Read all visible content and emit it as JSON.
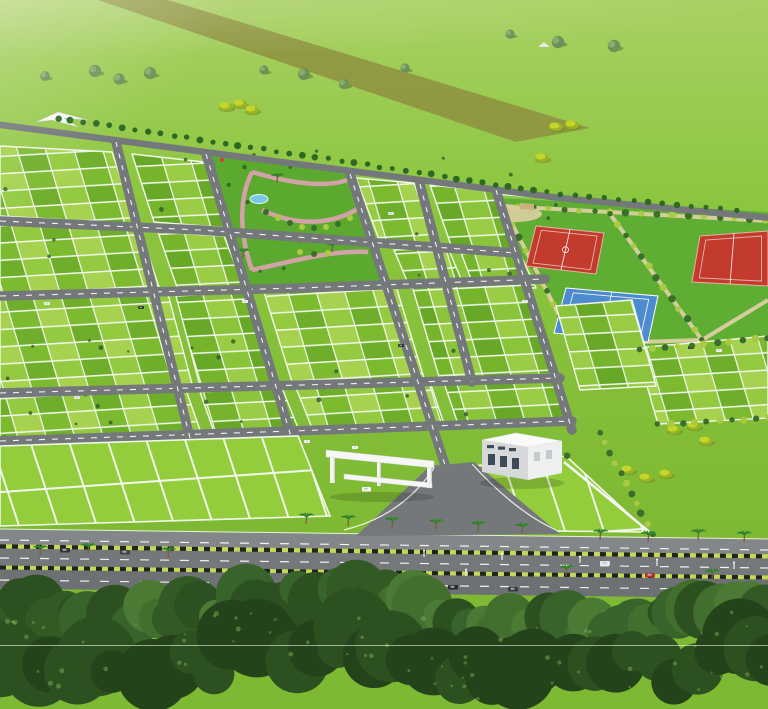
{
  "canvas": {
    "width": 768,
    "height": 709
  },
  "palette": {
    "field_top": "#a9d063",
    "field_mid": "#8cc63f",
    "field_low": "#7eb934",
    "haze": "#ffffff",
    "dirt_track": "#8e9140",
    "road": "#75787a",
    "road_light": "#84878a",
    "road_dark": "#6e7173",
    "road_dash": "#ffffff",
    "plot_greens_a": [
      "#a6d24f",
      "#7cba30",
      "#93ca40",
      "#6fae2b"
    ],
    "plot_greens_b": [
      "#9bcc45",
      "#76b42c",
      "#8ac43a",
      "#68a827"
    ],
    "front_green": "#93cd3b",
    "plot_line": "#f2f7ec",
    "park_lawn": "#5ca930",
    "park_path_pink": "#d2a2a8",
    "pond_blue": "#76c7e3",
    "sports_lawn": "#5fae33",
    "sand_path": "#dbcfa2",
    "court_red": "#c23b2c",
    "court_red_line": "#e9b0a6",
    "court_blue": "#4c8bcd",
    "court_blue_line": "#ffffff",
    "hedge_dark": "#3c6e2b",
    "hedge_light": "#a9cb42",
    "bush_yellow": "#c6d629",
    "bush_yellow_dark": "#99b424",
    "tree_gray_green": "#6f9157",
    "tree_gray_light": "#8aab6e",
    "boundary_tree": "#2c6a24",
    "white_structure": "#f6f6f4",
    "structure_shade": "#cfd1d3",
    "building_front": "#d6d8d9",
    "building_side": "#eef0f0",
    "building_roof": "#fafaf9",
    "window_dark": "#3e4b57",
    "curb_green": "#c6d856",
    "curb_black": "#20251a",
    "palm_leaf": "#2e7c28",
    "palm_leaf2": "#3f9233",
    "palm_trunk": "#7d5f3c",
    "canopy": [
      "#2d5020",
      "#38632a",
      "#426f2e",
      "#4a7a33",
      "#335a25"
    ],
    "canopy_dark": [
      "#24431b",
      "#2d5020"
    ],
    "canopy_speck": "#7fa855",
    "scan_line": "#eef3e8"
  },
  "field": {
    "dirt_track_pts": [
      [
        98,
        0
      ],
      [
        168,
        0
      ],
      [
        590,
        128
      ],
      [
        516,
        142
      ]
    ],
    "trees": [
      [
        45,
        76
      ],
      [
        95,
        71
      ],
      [
        119,
        79
      ],
      [
        150,
        73
      ],
      [
        264,
        70
      ],
      [
        304,
        74
      ],
      [
        344,
        84
      ],
      [
        405,
        68
      ],
      [
        510,
        34
      ],
      [
        558,
        42
      ],
      [
        614,
        46
      ]
    ],
    "hut": [
      544,
      44
    ],
    "yellow_bushes": [
      [
        226,
        107
      ],
      [
        240,
        104
      ],
      [
        252,
        110
      ],
      [
        542,
        158
      ],
      [
        556,
        127
      ],
      [
        572,
        125
      ],
      [
        628,
        470
      ],
      [
        646,
        478
      ],
      [
        666,
        474
      ],
      [
        674,
        430
      ],
      [
        694,
        426
      ],
      [
        706,
        441
      ]
    ]
  },
  "layout": {
    "boundary_road": "M -6 124 L 250 158 L 560 198 L 772 218",
    "boundary_trees": {
      "from": [
        58,
        118
      ],
      "to": [
        560,
        194
      ],
      "step": 13
    },
    "boundary_trees2": {
      "from": [
        560,
        194
      ],
      "to": [
        736,
        210
      ],
      "step": 14
    },
    "roads_a": [
      "M 0 221 L 200 230 L 420 246 L 516 253",
      "M 0 296 L 300 288 L 545 279",
      "M 0 393 L 340 384 L 560 378",
      "M 0 441 L 350 429 L 572 421"
    ],
    "roads_b": [
      "M 116 142 L 190 438",
      "M 206 154 L 292 440",
      "M 350 174 L 446 468 L 470 532",
      "M 420 184 L 472 382",
      "M 496 190 L 572 430"
    ],
    "blocks": [
      [
        [
          0,
          146
        ],
        [
          112,
          152
        ],
        [
          136,
          224
        ],
        [
          0,
          216
        ]
      ],
      [
        [
          132,
          154
        ],
        [
          204,
          162
        ],
        [
          230,
          228
        ],
        [
          154,
          222
        ]
      ],
      [
        [
          356,
          178
        ],
        [
          414,
          183
        ],
        [
          438,
          248
        ],
        [
          380,
          242
        ]
      ],
      [
        [
          430,
          185
        ],
        [
          492,
          191
        ],
        [
          516,
          252
        ],
        [
          452,
          248
        ]
      ],
      [
        [
          0,
          224
        ],
        [
          140,
          230
        ],
        [
          162,
          296
        ],
        [
          0,
          292
        ]
      ],
      [
        [
          158,
          232
        ],
        [
          224,
          236
        ],
        [
          248,
          298
        ],
        [
          180,
          296
        ]
      ],
      [
        [
          394,
          250
        ],
        [
          448,
          248
        ],
        [
          464,
          286
        ],
        [
          410,
          288
        ]
      ],
      [
        [
          460,
          250
        ],
        [
          520,
          254
        ],
        [
          536,
          288
        ],
        [
          474,
          287
        ]
      ],
      [
        [
          0,
          300
        ],
        [
          168,
          294
        ],
        [
          192,
          384
        ],
        [
          0,
          390
        ]
      ],
      [
        [
          176,
          296
        ],
        [
          248,
          292
        ],
        [
          274,
          382
        ],
        [
          200,
          386
        ]
      ],
      [
        [
          264,
          292
        ],
        [
          396,
          286
        ],
        [
          424,
          378
        ],
        [
          292,
          382
        ]
      ],
      [
        [
          412,
          286
        ],
        [
          524,
          280
        ],
        [
          550,
          374
        ],
        [
          440,
          380
        ]
      ],
      [
        [
          0,
          396
        ],
        [
          186,
          390
        ],
        [
          200,
          430
        ],
        [
          0,
          438
        ]
      ],
      [
        [
          200,
          392
        ],
        [
          282,
          388
        ],
        [
          298,
          428
        ],
        [
          214,
          432
        ]
      ],
      [
        [
          296,
          388
        ],
        [
          430,
          382
        ],
        [
          444,
          424
        ],
        [
          312,
          428
        ]
      ],
      [
        [
          444,
          383
        ],
        [
          556,
          378
        ],
        [
          568,
          420
        ],
        [
          458,
          424
        ]
      ],
      [
        [
          636,
          348
        ],
        [
          768,
          336
        ],
        [
          768,
          418
        ],
        [
          658,
          424
        ]
      ],
      [
        [
          556,
          306
        ],
        [
          632,
          300
        ],
        [
          656,
          386
        ],
        [
          580,
          390
        ]
      ]
    ],
    "front_blocks": [
      [
        [
          0,
          446
        ],
        [
          298,
          436
        ],
        [
          330,
          516
        ],
        [
          0,
          526
        ]
      ],
      [
        [
          436,
          470
        ],
        [
          566,
          456
        ],
        [
          648,
          532
        ],
        [
          448,
          530
        ]
      ]
    ],
    "hedge_rows": [
      {
        "from": [
          600,
          432
        ],
        "to": [
          652,
          534
        ],
        "step": 11
      },
      {
        "from": [
          658,
          424
        ],
        "to": [
          768,
          418
        ],
        "step": 12
      },
      {
        "from": [
          640,
          350
        ],
        "to": [
          768,
          338
        ],
        "step": 12
      },
      {
        "from": [
          436,
          470
        ],
        "to": [
          566,
          456
        ],
        "step": 13
      }
    ],
    "boundary_wall": "M 564 462 L 652 534",
    "vehicles": [
      [
        44,
        302,
        "#f2f2f2"
      ],
      [
        138,
        306,
        "#333333"
      ],
      [
        242,
        300,
        "#f2f2f2"
      ],
      [
        74,
        396,
        "#e8e8e8"
      ],
      [
        252,
        442,
        "#bb3a2e"
      ],
      [
        304,
        440,
        "#f5f5f5"
      ],
      [
        352,
        446,
        "#ffffff"
      ],
      [
        398,
        344,
        "#333333"
      ],
      [
        388,
        212,
        "#e5e5e5"
      ],
      [
        522,
        300,
        "#f0f0f0"
      ],
      [
        688,
        346,
        "#333333"
      ],
      [
        716,
        349,
        "#f5f5f5"
      ]
    ]
  },
  "park": {
    "lawn_pts": [
      [
        208,
        156
      ],
      [
        352,
        172
      ],
      [
        390,
        284
      ],
      [
        246,
        292
      ]
    ],
    "paths": [
      "M 252 270 C 240 236 238 200 252 172",
      "M 252 172 C 300 186 336 188 356 176",
      "M 252 270 C 290 262 330 250 368 252",
      "M 262 210 C 300 228 336 224 362 206"
    ],
    "pond": {
      "cx": 259,
      "cy": 199,
      "rx": 9,
      "ry": 4.5
    },
    "playground": [
      [
        196,
        163,
        "#cc4434"
      ],
      [
        205,
        159,
        "#d7a13a"
      ],
      [
        213,
        164,
        "#4a7fbf"
      ],
      [
        222,
        160,
        "#cc4434"
      ]
    ],
    "palms": [
      [
        277,
        183
      ],
      [
        300,
        243
      ],
      [
        332,
        252
      ],
      [
        243,
        258
      ]
    ],
    "hedges": [
      [
        266,
        212
      ],
      [
        278,
        218
      ],
      [
        290,
        223
      ],
      [
        302,
        227
      ],
      [
        314,
        228
      ],
      [
        326,
        227
      ],
      [
        338,
        224
      ],
      [
        350,
        218
      ],
      [
        360,
        210
      ],
      [
        300,
        252
      ],
      [
        314,
        254
      ],
      [
        328,
        253
      ]
    ],
    "canopy_pts": [
      [
        36,
        122
      ],
      [
        58,
        112
      ],
      [
        88,
        120
      ],
      [
        64,
        118
      ],
      [
        78,
        127
      ],
      [
        52,
        120
      ]
    ]
  },
  "sports": {
    "lawn_pts": [
      [
        498,
        198
      ],
      [
        768,
        212
      ],
      [
        768,
        356
      ],
      [
        650,
        352
      ],
      [
        560,
        312
      ],
      [
        516,
        248
      ]
    ],
    "paths": [
      "M 502 206 L 768 221",
      "M 505 210 L 574 344",
      "M 610 214 L 702 340",
      "M 574 344 L 702 340",
      "M 702 340 L 768 300"
    ],
    "hedge_segs": [
      {
        "from": [
          502,
          206
        ],
        "to": [
          766,
          220
        ],
        "step": 15
      },
      {
        "from": [
          505,
          210
        ],
        "to": [
          574,
          344
        ],
        "step": 14
      },
      {
        "from": [
          610,
          214
        ],
        "to": [
          702,
          340
        ],
        "step": 13
      }
    ],
    "wall_segs": [
      [
        [
          500,
          191
        ],
        [
          536,
          194
        ],
        [
          536,
          198
        ],
        [
          500,
          195
        ]
      ],
      [
        [
          542,
          195
        ],
        [
          566,
          197
        ],
        [
          566,
          201
        ],
        [
          542,
          199
        ]
      ]
    ],
    "sand": {
      "cx": 516,
      "cy": 214,
      "rx": 26,
      "ry": 8
    },
    "sand_box": [
      [
        520,
        203
      ],
      [
        534,
        204
      ],
      [
        534,
        210
      ],
      [
        520,
        209
      ]
    ],
    "courts": [
      {
        "kind": "basketball",
        "pts": [
          [
            536,
            226
          ],
          [
            604,
            233
          ],
          [
            596,
            274
          ],
          [
            526,
            266
          ]
        ]
      },
      {
        "kind": "tennis",
        "pts": [
          [
            566,
            288
          ],
          [
            658,
            296
          ],
          [
            648,
            342
          ],
          [
            554,
            333
          ]
        ]
      },
      {
        "kind": "generic_red",
        "pts": [
          [
            700,
            236
          ],
          [
            768,
            231
          ],
          [
            768,
            286
          ],
          [
            692,
            282
          ]
        ]
      }
    ]
  },
  "entrance": {
    "merge_road_pts": [
      [
        430,
        466
      ],
      [
        474,
        462
      ],
      [
        560,
        534
      ],
      [
        356,
        536
      ]
    ],
    "merge_edges": [
      "M 434 468 Q 402 516 344 530",
      "M 472 464 Q 516 512 556 530"
    ],
    "beam_top_pts": [
      [
        326,
        450
      ],
      [
        434,
        461
      ],
      [
        434,
        468
      ],
      [
        326,
        457
      ]
    ],
    "beam_low_pts": [
      [
        344,
        474
      ],
      [
        432,
        483
      ],
      [
        432,
        488
      ],
      [
        344,
        479
      ]
    ],
    "pillars": [
      [
        330,
        456,
        5,
        27
      ],
      [
        377,
        460,
        4,
        26
      ],
      [
        427,
        464,
        5,
        24
      ]
    ],
    "gate_car": [
      362,
      487
    ]
  },
  "building": {
    "front_pts": [
      [
        482,
        440
      ],
      [
        528,
        447
      ],
      [
        528,
        480
      ],
      [
        482,
        472
      ]
    ],
    "side_pts": [
      [
        528,
        447
      ],
      [
        562,
        441
      ],
      [
        562,
        473
      ],
      [
        528,
        480
      ]
    ],
    "roof_pts": [
      [
        482,
        440
      ],
      [
        516,
        433
      ],
      [
        562,
        441
      ],
      [
        528,
        447
      ]
    ],
    "small_windows": [
      [
        487,
        445
      ],
      [
        498,
        446.5
      ],
      [
        509,
        448
      ]
    ],
    "tall_windows": [
      [
        488,
        454
      ],
      [
        500,
        456
      ],
      [
        512,
        458
      ]
    ],
    "side_windows": [
      [
        534,
        452
      ],
      [
        546,
        450
      ]
    ]
  },
  "highway": {
    "top_edge": "M 0 529 L 768 539",
    "service_lane": "M 0 537 L 768 547",
    "curb1": "M 0 546.5 L 768 556.5",
    "lane1": "M 0 557 L 768 567",
    "curb2": "M 0 567.5 L 768 577.5",
    "lane2": "M 0 579 L 768 589",
    "dash_lines": [
      "M 0 540 L 768 550",
      "M 0 558 L 768 568",
      "M 0 580 L 768 590"
    ],
    "palms": [
      [
        306,
        524
      ],
      [
        348,
        526
      ],
      [
        392,
        528
      ],
      [
        436,
        530
      ],
      [
        478,
        532
      ],
      [
        522,
        534
      ],
      [
        600,
        540
      ],
      [
        648,
        542
      ],
      [
        698,
        540
      ],
      [
        744,
        542
      ],
      [
        40,
        556
      ],
      [
        88,
        554
      ],
      [
        168,
        558
      ],
      [
        566,
        576
      ],
      [
        712,
        580
      ]
    ],
    "lamps": [
      [
        502,
        560
      ],
      [
        580,
        563
      ],
      [
        657,
        566
      ],
      [
        734,
        569
      ],
      [
        424,
        557
      ],
      [
        466,
        576
      ]
    ],
    "vehicles": [
      [
        60,
        548,
        "#333333"
      ],
      [
        120,
        550,
        "#444444"
      ],
      [
        350,
        560,
        "#2f2f2f"
      ],
      [
        600,
        561,
        "#e8e8e8"
      ],
      [
        645,
        573,
        "#b23430"
      ],
      [
        448,
        585,
        "#2a2a2a"
      ],
      [
        508,
        587,
        "#3a3a3a"
      ],
      [
        700,
        592,
        "#333333"
      ],
      [
        380,
        581,
        "#2d2d2d"
      ]
    ]
  },
  "foreground": {
    "seed": 7,
    "blob_count": 58,
    "lower_count": 42,
    "speck_count": 70
  },
  "artifacts": {
    "scan_line_y": 645.5,
    "plot_speck_count": 46
  }
}
